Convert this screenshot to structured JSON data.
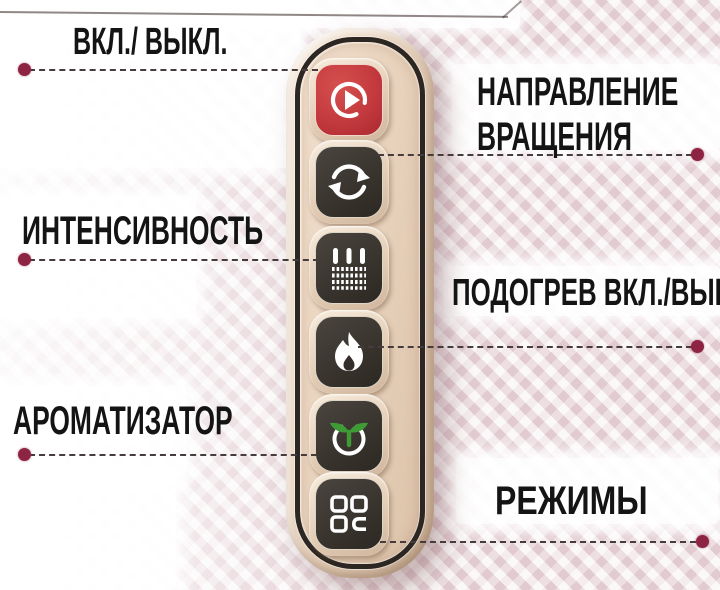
{
  "callouts": {
    "power": {
      "label": "ВКЛ./ ВЫКЛ."
    },
    "direction": {
      "label_line1": "НАПРАВЛЕНИЕ",
      "label_line2": "ВРАЩЕНИЯ"
    },
    "intensity": {
      "label": "ИНТЕНСИВНОСТЬ"
    },
    "heating": {
      "label": "ПОДОГРЕВ ВКЛ./ВЫКЛ."
    },
    "aroma": {
      "label": "АРОМАТИЗАТОР"
    },
    "modes": {
      "label": "РЕЖИМЫ"
    }
  },
  "device": {
    "type": "massager-control-panel",
    "buttons": [
      {
        "name": "power-button",
        "icon": "play-circle-icon",
        "color": "#c43a3e"
      },
      {
        "name": "rotation-button",
        "icon": "rotate-arrows-icon",
        "color": "#38332e"
      },
      {
        "name": "intensity-button",
        "icon": "massage-intensity-icon",
        "color": "#38332e"
      },
      {
        "name": "heating-button",
        "icon": "flame-icon",
        "color": "#38332e"
      },
      {
        "name": "aroma-button",
        "icon": "sprout-icon",
        "color": "#38332e"
      },
      {
        "name": "modes-button",
        "icon": "grid-modes-icon",
        "color": "#38332e"
      }
    ],
    "body_color": "#e8d3bf",
    "ring_color": "#2c2722"
  },
  "colors": {
    "callout_dot": "#8e2444",
    "dashed_line": "#463b3d",
    "label_text": "#141414",
    "background_pink": "#ecdee1",
    "accent_green": "#3f9b35",
    "button_red": "#c43a3e"
  }
}
